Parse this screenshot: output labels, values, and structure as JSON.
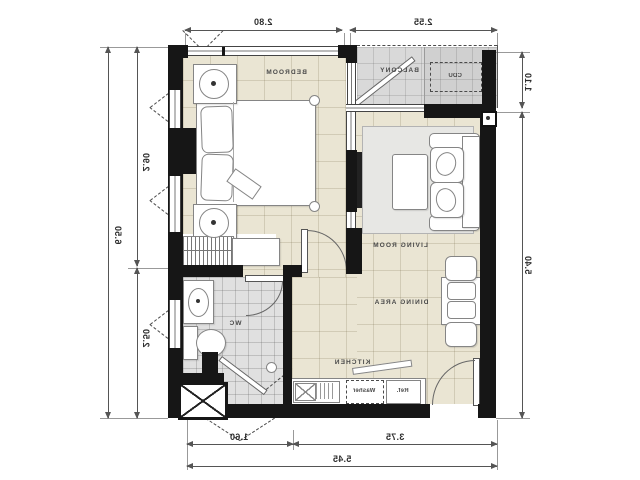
{
  "plan_title": "apartment-unit-floor-plan",
  "rooms": {
    "bedroom": "BEDROOM",
    "balcony": "BALCONY",
    "cdu": "CDU",
    "living_room": "LIVING ROOM",
    "dining_area": "DINING AREA",
    "kitchen": "KITCHEN",
    "wc": "WC"
  },
  "appliances": {
    "washer": "Washer",
    "ref": "Ref."
  },
  "dimensions": {
    "top_bedroom": "2.80",
    "top_balcony": "2.55",
    "left_overall": "6.50",
    "left_upper": "2.90",
    "left_lower": "2.50",
    "right_upper": "1.10",
    "right_lower": "5.40",
    "bottom_left": "1.60",
    "bottom_right": "3.75",
    "bottom_overall": "5.45"
  },
  "colors": {
    "wall": "#161616",
    "floor_main": "#eae5d3",
    "floor_wet": "#e0e0e0",
    "floor_balcony": "#d9d9d9",
    "dimension_line": "#555555"
  }
}
